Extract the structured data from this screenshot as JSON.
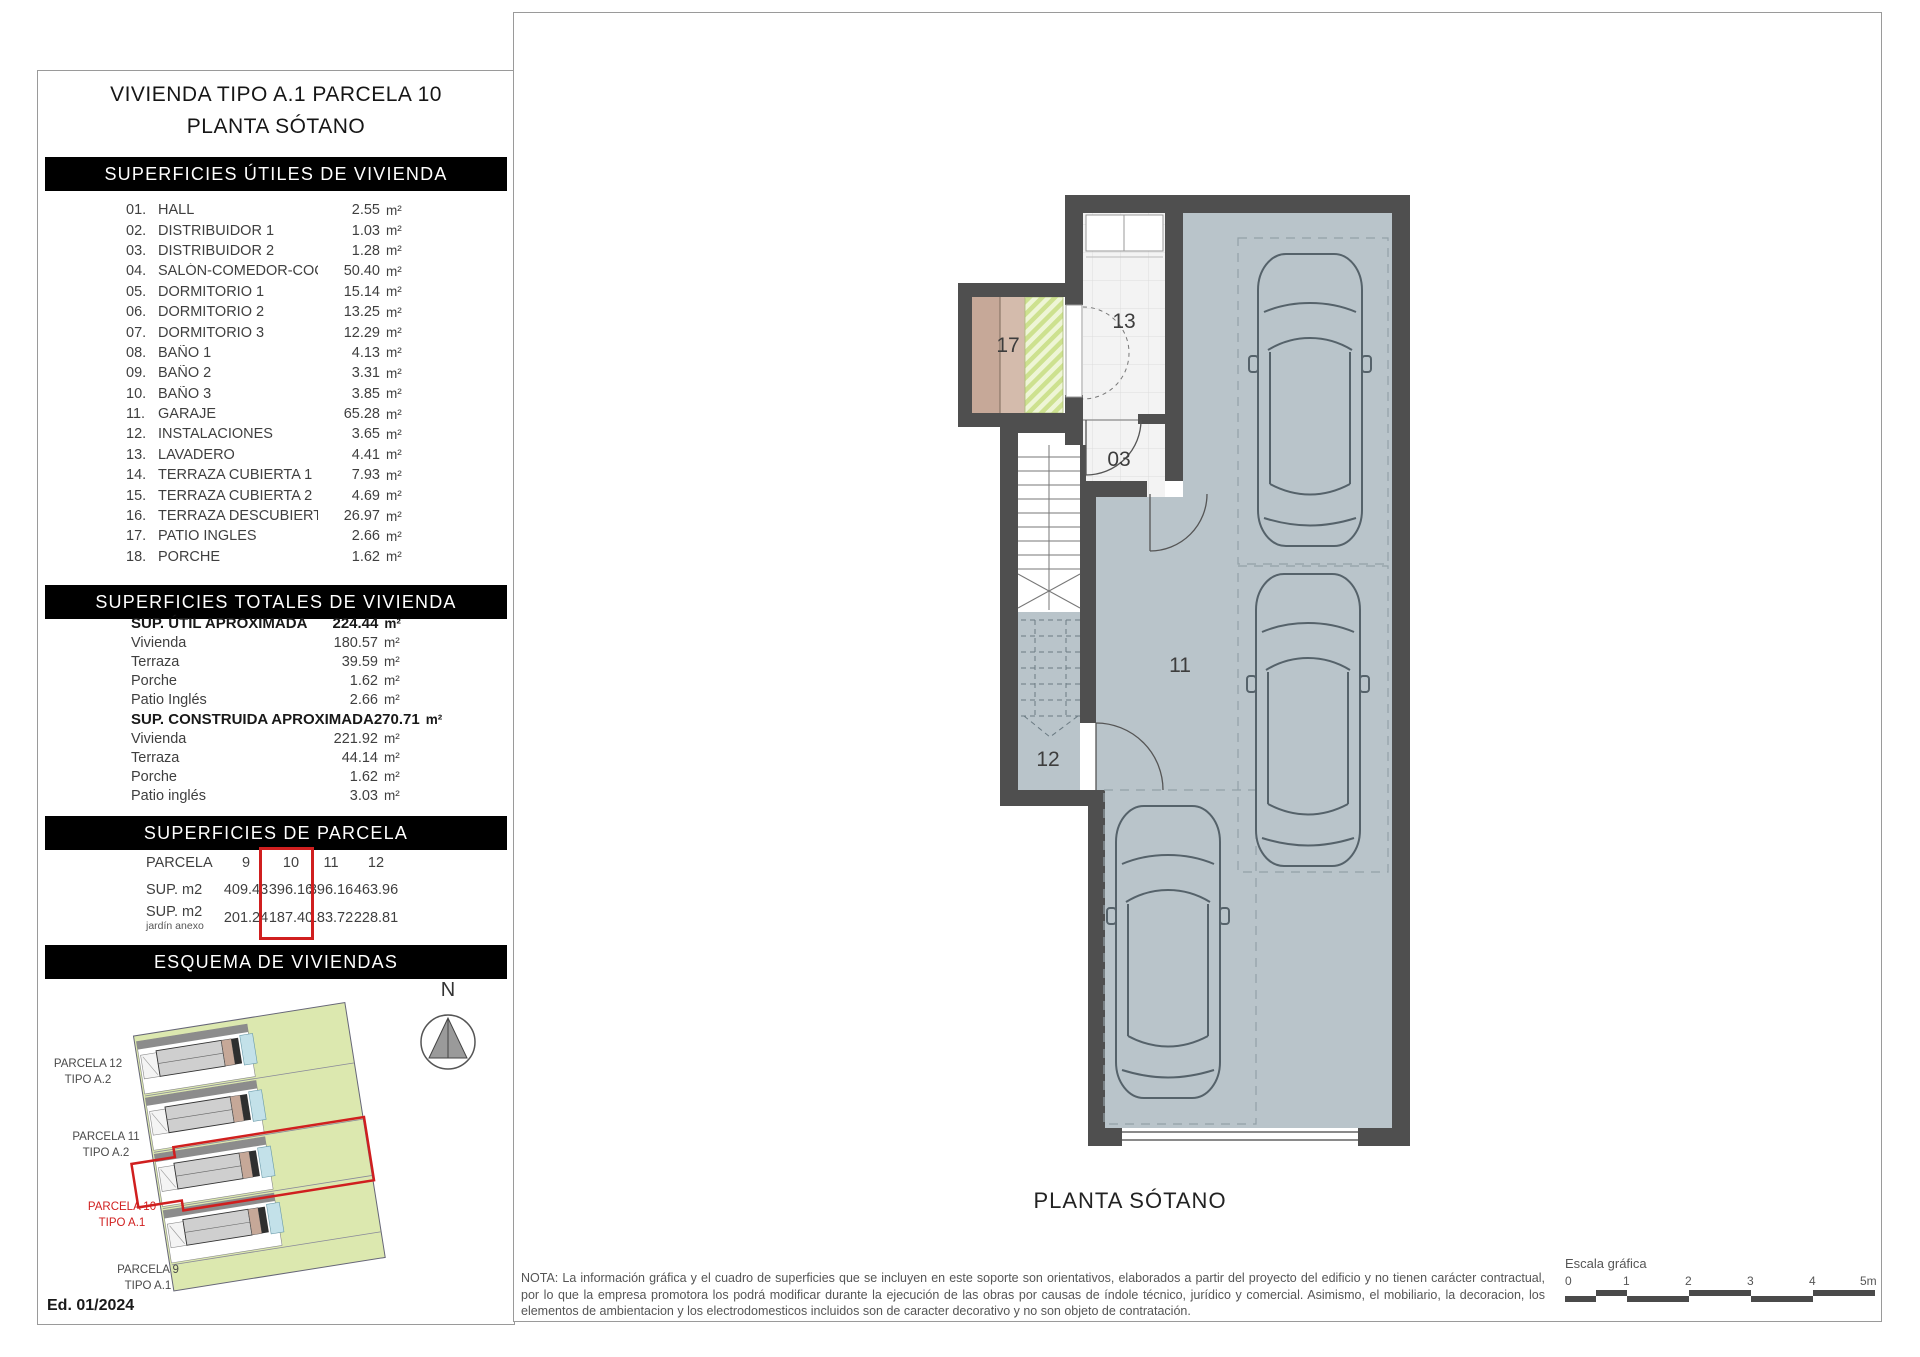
{
  "page": {
    "title_line1": "VIVIENDA TIPO A.1 PARCELA 10",
    "title_line2": "PLANTA SÓTANO"
  },
  "left_panel": {
    "headers": {
      "utiles": "SUPERFICIES ÚTILES DE VIVIENDA",
      "totales": "SUPERFICIES TOTALES DE VIVIENDA",
      "parcela": "SUPERFICIES DE PARCELA",
      "esquema": "ESQUEMA DE VIVIENDAS"
    },
    "unit": "m²",
    "rooms": [
      {
        "num": "01.",
        "name": "HALL",
        "value": "2.55"
      },
      {
        "num": "02.",
        "name": "DISTRIBUIDOR 1",
        "value": "1.03"
      },
      {
        "num": "03.",
        "name": "DISTRIBUIDOR 2",
        "value": "1.28"
      },
      {
        "num": "04.",
        "name": "SALÓN-COMEDOR-COCINA",
        "value": "50.40"
      },
      {
        "num": "05.",
        "name": "DORMITORIO 1",
        "value": "15.14"
      },
      {
        "num": "06.",
        "name": "DORMITORIO 2",
        "value": "13.25"
      },
      {
        "num": "07.",
        "name": "DORMITORIO 3",
        "value": "12.29"
      },
      {
        "num": "08.",
        "name": "BAÑO 1",
        "value": "4.13"
      },
      {
        "num": "09.",
        "name": "BAÑO 2",
        "value": "3.31"
      },
      {
        "num": "10.",
        "name": "BAÑO 3",
        "value": "3.85"
      },
      {
        "num": "11.",
        "name": "GARAJE",
        "value": "65.28"
      },
      {
        "num": "12.",
        "name": "INSTALACIONES",
        "value": "3.65"
      },
      {
        "num": "13.",
        "name": "LAVADERO",
        "value": "4.41"
      },
      {
        "num": "14.",
        "name": "TERRAZA CUBIERTA 1",
        "value": "7.93"
      },
      {
        "num": "15.",
        "name": "TERRAZA CUBIERTA 2",
        "value": "4.69"
      },
      {
        "num": "16.",
        "name": "TERRAZA DESCUBIERTA",
        "value": "26.97"
      },
      {
        "num": "17.",
        "name": "PATIO INGLES",
        "value": "2.66"
      },
      {
        "num": "18.",
        "name": "PORCHE",
        "value": "1.62"
      }
    ],
    "totals_util": {
      "label": "SUP. ÚTIL APROXIMADA",
      "value": "224.44",
      "rows": [
        {
          "label": "Vivienda",
          "value": "180.57"
        },
        {
          "label": "Terraza",
          "value": "39.59"
        },
        {
          "label": "Porche",
          "value": "1.62"
        },
        {
          "label": "Patio Inglés",
          "value": "2.66"
        }
      ]
    },
    "totals_built": {
      "label": "SUP. CONSTRUIDA APROXIMADA",
      "value": "270.71",
      "rows": [
        {
          "label": "Vivienda",
          "value": "221.92"
        },
        {
          "label": "Terraza",
          "value": "44.14"
        },
        {
          "label": "Porche",
          "value": "1.62"
        },
        {
          "label": "Patio inglés",
          "value": "3.03"
        }
      ]
    },
    "parcela_table": {
      "col_header_label": "PARCELA",
      "columns": [
        "9",
        "10",
        "11",
        "12"
      ],
      "row_sup_label": "SUP. m2",
      "row_sup": [
        "409.43",
        "396.16",
        "396.16",
        "463.96"
      ],
      "row_jardin_label": "SUP. m2",
      "row_jardin_sublabel": "jardín anexo",
      "row_jardin": [
        "201.24",
        "187.40",
        "183.72",
        "228.81"
      ],
      "highlighted_column": "10"
    },
    "esquema_labels": [
      {
        "line1": "PARCELA 12",
        "line2": "TIPO A.2",
        "highlight": false
      },
      {
        "line1": "PARCELA 11",
        "line2": "TIPO A.2",
        "highlight": false
      },
      {
        "line1": "PARCELA 10",
        "line2": "TIPO A.1",
        "highlight": true
      },
      {
        "line1": "PARCELA 9",
        "line2": "TIPO A.1",
        "highlight": false
      }
    ],
    "north_letter": "N",
    "edition": "Ed. 01/2024"
  },
  "plan": {
    "caption": "PLANTA SÓTANO",
    "room_labels": {
      "r17": "17",
      "r13": "13",
      "r03": "03",
      "r11": "11",
      "r12": "12"
    }
  },
  "footer": {
    "note": "NOTA: La información gráfica y el cuadro de superficies que se incluyen en este soporte son orientativos, elaborados a partir del proyecto del edificio y no tienen carácter contractual, por lo que la empresa promotora los podrá modificar durante la ejecución de las obras por causas de índole técnico, jurídico y comercial. Asimismo, el mobiliario, la decoracion, los elementos de ambientacion y los electrodomesticos incluidos son de caracter decorativo y no son objeto de contratación.",
    "scale_label": "Escala gráfica",
    "scale_ticks": [
      "0",
      "1",
      "2",
      "3",
      "4",
      "5m"
    ]
  },
  "colors": {
    "accent_red": "#d01f1f",
    "wall_gray": "#4f4f4f",
    "garage_floor": "#b9c4ca",
    "scheme_green": "#dce8af",
    "pool_blue": "#c3e1e9",
    "terrace_tan": "#c6a898",
    "hatch_green": "#cde18f"
  }
}
